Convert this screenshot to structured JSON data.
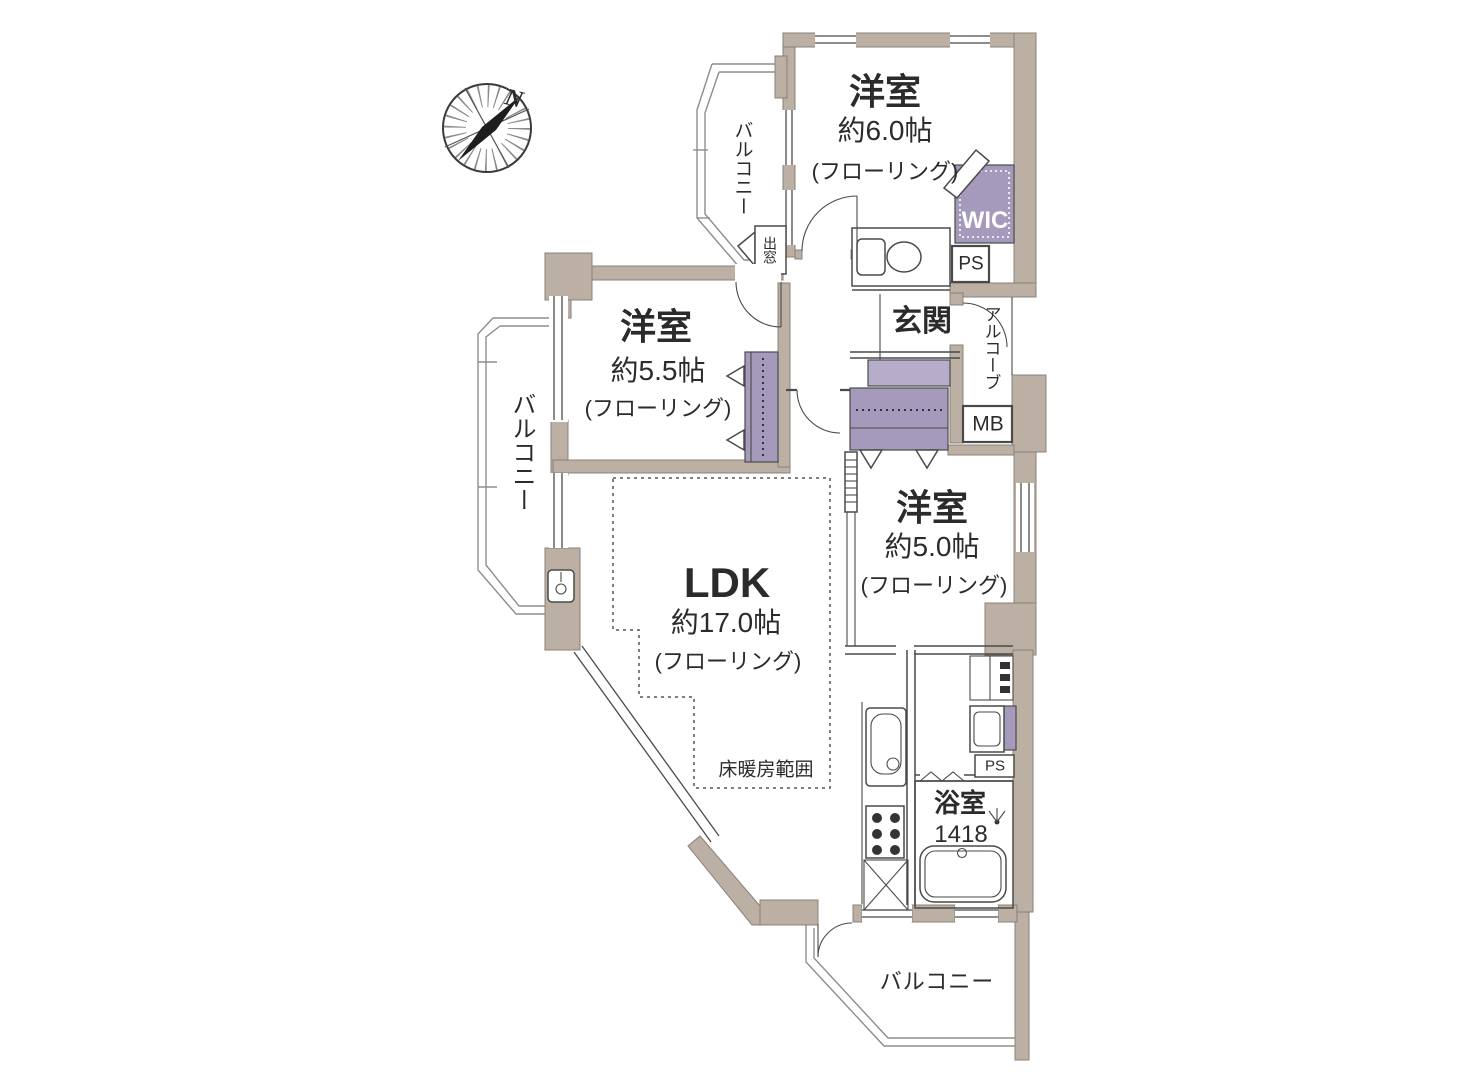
{
  "colors": {
    "wall": "#bcb0a4",
    "wall_stroke": "#8a8078",
    "line": "#4a4a48",
    "fixture": "#a59abc",
    "fixture_light": "#b6adca",
    "text": "#2b2b2b"
  },
  "compass": {
    "north_label": "N"
  },
  "rooms": {
    "bedroom_top": {
      "name": "洋室",
      "size": "約6.0帖",
      "floor": "(フローリング)"
    },
    "bedroom_mid": {
      "name": "洋室",
      "size": "約5.5帖",
      "floor": "(フローリング)"
    },
    "bedroom_right": {
      "name": "洋室",
      "size": "約5.0帖",
      "floor": "(フローリング)"
    },
    "ldk": {
      "name": "LDK",
      "size": "約17.0帖",
      "floor": "(フローリング)",
      "floor_heating": "床暖房範囲"
    },
    "entrance": {
      "name": "玄関"
    },
    "bathroom": {
      "name": "浴室",
      "size": "1418"
    }
  },
  "labels": {
    "wic": "WIC",
    "ps_top": "PS",
    "ps_bottom": "PS",
    "mb": "MB",
    "alcove": "アルコーブ",
    "bay_window": "出窓",
    "balcony_top": "バルコニー",
    "balcony_left": "バルコニー",
    "balcony_bottom": "バルコニー"
  }
}
